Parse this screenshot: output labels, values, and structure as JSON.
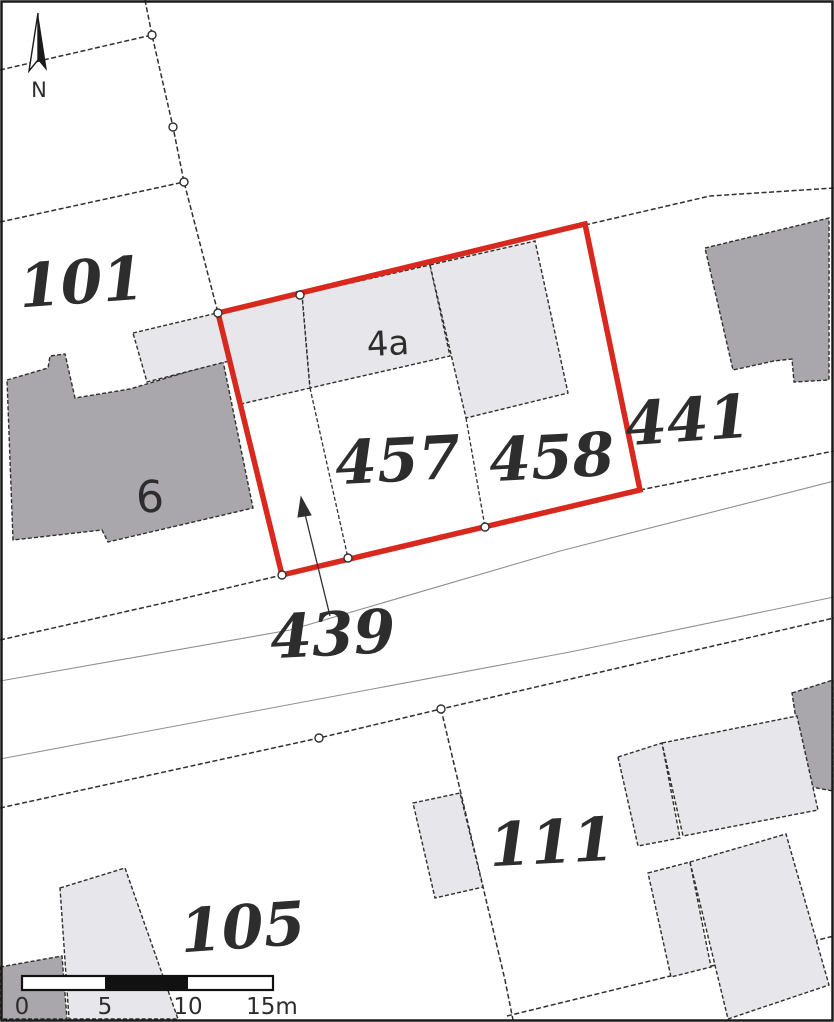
{
  "document": {
    "type": "cadastral-site-plan-extract"
  },
  "colors": {
    "red": "#d9291f",
    "building_light": "#e6e6eb",
    "building_dark": "#a9a7ab",
    "line_dark": "#2f2f2f",
    "line_thin": "#8f8f8f",
    "text": "#2d2d2d"
  },
  "parcels": {
    "p101": "101",
    "p441": "441",
    "p457": "457",
    "p458": "458",
    "p439": "439",
    "p111": "111",
    "p105": "105"
  },
  "houses": {
    "h4a": "4a",
    "h6": "6"
  },
  "north": {
    "label": "N"
  },
  "scalebar": {
    "t0": "0",
    "t5": "5",
    "t10": "10",
    "t15": "15m"
  }
}
